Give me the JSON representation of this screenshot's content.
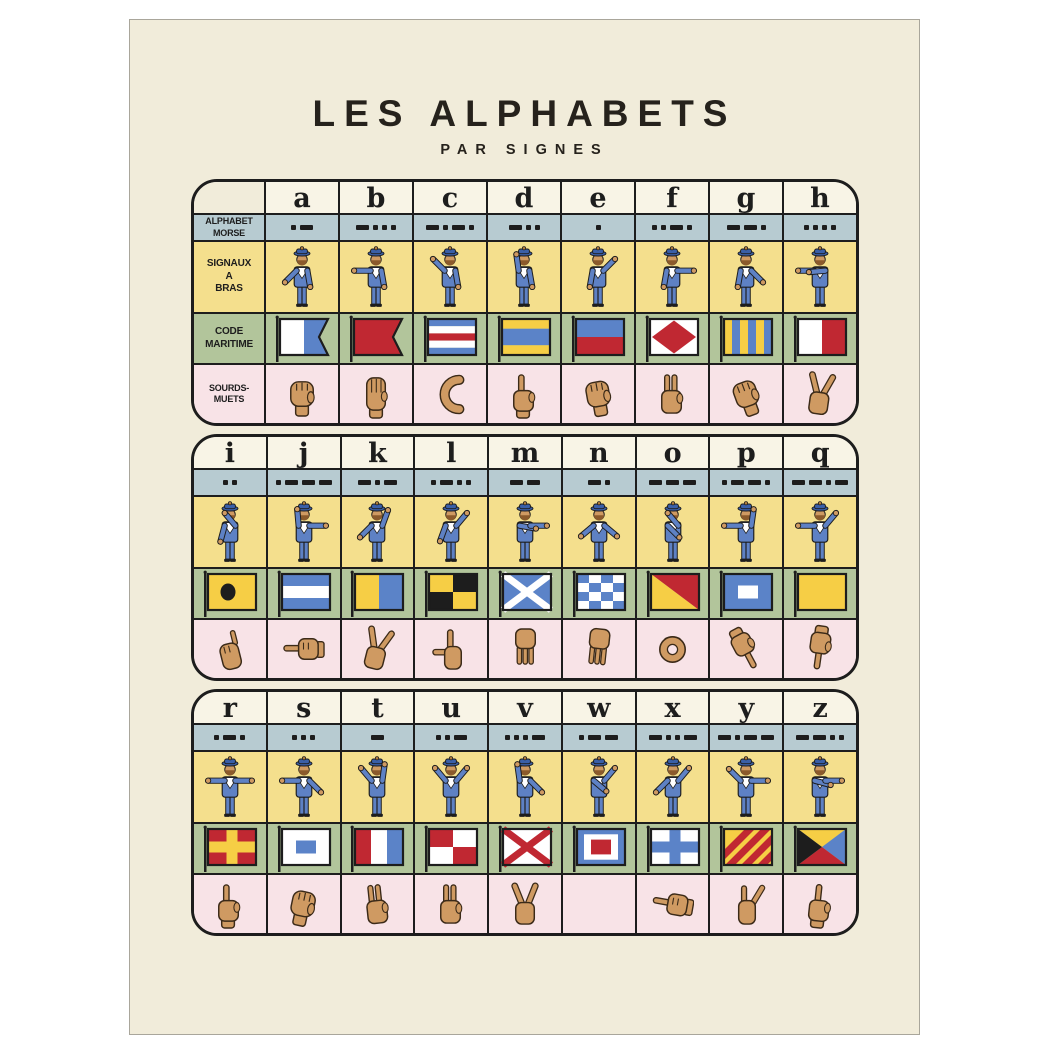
{
  "title": {
    "main": "LES ALPHABETS",
    "sub": "PAR SIGNES"
  },
  "row_labels": {
    "morse": "ALPHABET MORSE",
    "signaux_lines": [
      "SIGNAUX",
      "A",
      "BRAS"
    ],
    "maritime_lines": [
      "CODE",
      "MARITIME"
    ],
    "sourds": "SOURDS-MUETS"
  },
  "colors": {
    "poster_bg": "#f1ecda",
    "header_bg": "#f8f4e6",
    "morse_row": "#b7cbd1",
    "signaux_row": "#f4df8d",
    "maritime_row": "#b2c59b",
    "sourds_row": "#f8e3e7",
    "ink": "#1d1d1d",
    "flag_red": "#c02832",
    "flag_blue": "#5b83c8",
    "flag_yellow": "#f6ce45",
    "flag_white": "#ffffff",
    "flag_black": "#1d1d1d",
    "sailor_blue": "#5e81c4",
    "sailor_hat": "#3a5fa8",
    "skin": "#cf9a62"
  },
  "blocks": [
    {
      "letters": [
        "a",
        "b",
        "c",
        "d",
        "e",
        "f",
        "g",
        "h"
      ],
      "has_label_column": true
    },
    {
      "letters": [
        "i",
        "j",
        "k",
        "l",
        "m",
        "n",
        "o",
        "p",
        "q"
      ],
      "has_label_column": false
    },
    {
      "letters": [
        "r",
        "s",
        "t",
        "u",
        "v",
        "w",
        "x",
        "y",
        "z"
      ],
      "has_label_column": false
    }
  ],
  "alphabet": {
    "a": {
      "morse": ".-",
      "semaphore": {
        "la": 45,
        "ra": 10
      },
      "flag": {
        "kind": "swallowtail_vsplit",
        "colors": [
          "flag_white",
          "flag_blue"
        ]
      },
      "hand": "closed-fist",
      "hand_symbol": "hand-fist",
      "hand_rot": 0
    },
    "b": {
      "morse": "-...",
      "semaphore": {
        "la": 90,
        "ra": 10
      },
      "flag": {
        "kind": "swallowtail",
        "colors": [
          "flag_red"
        ]
      },
      "hand": "flat-hand-fingers-up",
      "hand_symbol": "hand-flat",
      "hand_rot": 0
    },
    "c": {
      "morse": "-.-.",
      "semaphore": {
        "la": 135,
        "ra": 10
      },
      "flag": {
        "kind": "hstripes",
        "colors": [
          "flag_blue",
          "flag_white",
          "flag_red",
          "flag_white",
          "flag_blue"
        ]
      },
      "hand": "c-shape",
      "hand_symbol": "hand-c",
      "hand_rot": 0
    },
    "d": {
      "morse": "-..",
      "semaphore": {
        "la": 172,
        "ra": 10
      },
      "flag": {
        "kind": "hstripes",
        "weights": [
          1,
          1.7,
          1
        ],
        "colors": [
          "flag_yellow",
          "flag_blue",
          "flag_yellow"
        ]
      },
      "hand": "index-up-curved",
      "hand_symbol": "hand-point-up",
      "hand_rot": 0
    },
    "e": {
      "morse": ".",
      "semaphore": {
        "la": 10,
        "ra": 135
      },
      "flag": {
        "kind": "hstripes",
        "colors": [
          "flag_blue",
          "flag_red"
        ]
      },
      "hand": "curled-fist",
      "hand_symbol": "hand-fist",
      "hand_rot": -10
    },
    "f": {
      "morse": "..-.",
      "semaphore": {
        "la": 10,
        "ra": 90
      },
      "flag": {
        "kind": "diamond",
        "colors": [
          "flag_white",
          "flag_red"
        ]
      },
      "hand": "two-fingers-thumb-circle",
      "hand_symbol": "hand-two-up",
      "hand_rot": 0
    },
    "g": {
      "morse": "--.",
      "semaphore": {
        "la": 10,
        "ra": 45
      },
      "flag": {
        "kind": "vstripes",
        "colors": [
          "flag_yellow",
          "flag_blue",
          "flag_yellow",
          "flag_blue",
          "flag_yellow",
          "flag_blue"
        ]
      },
      "hand": "bent-knuckles",
      "hand_symbol": "hand-fist",
      "hand_rot": -20
    },
    "h": {
      "morse": "....",
      "semaphore": {
        "la": 90,
        "ra": -85
      },
      "flag": {
        "kind": "vstripes",
        "colors": [
          "flag_white",
          "flag_red"
        ]
      },
      "hand": "two-fingers-spread",
      "hand_symbol": "hand-v",
      "hand_rot": 8
    },
    "i": {
      "morse": "..",
      "semaphore": {
        "la": 15,
        "ra": -140
      },
      "flag": {
        "kind": "circle",
        "colors": [
          "flag_yellow",
          "flag_black"
        ]
      },
      "hand": "pinky-raised",
      "hand_symbol": "hand-pinky",
      "hand_rot": -14
    },
    "j": {
      "morse": ".---",
      "semaphore": {
        "la": 175,
        "ra": 90
      },
      "flag": {
        "kind": "hstripes",
        "colors": [
          "flag_blue",
          "flag_white",
          "flag_blue"
        ]
      },
      "hand": "hand-pointing-left",
      "hand_symbol": "hand-point-left",
      "hand_rot": 0
    },
    "k": {
      "morse": "-.-",
      "semaphore": {
        "la": 45,
        "ra": 160
      },
      "flag": {
        "kind": "vstripes",
        "colors": [
          "flag_yellow",
          "flag_blue"
        ]
      },
      "hand": "index-middle-diagonal",
      "hand_symbol": "hand-v",
      "hand_rot": 14
    },
    "l": {
      "morse": ".-..",
      "semaphore": {
        "la": 20,
        "ra": 140
      },
      "flag": {
        "kind": "quarters",
        "colors": [
          "flag_yellow",
          "flag_black",
          "flag_black",
          "flag_yellow"
        ]
      },
      "hand": "l-shape-thumb-out",
      "hand_symbol": "hand-l",
      "hand_rot": 0
    },
    "m": {
      "morse": "--",
      "semaphore": {
        "la": -80,
        "ra": 90
      },
      "flag": {
        "kind": "saltire",
        "colors": [
          "flag_blue",
          "flag_white"
        ]
      },
      "hand": "three-fingers-down",
      "hand_symbol": "hand-fingers-down",
      "hand_rot": 0
    },
    "n": {
      "morse": "-.",
      "semaphore": {
        "la": 50,
        "ra": 50
      },
      "flag": {
        "kind": "checker",
        "colors": [
          "flag_blue",
          "flag_white"
        ]
      },
      "hand": "two-fingers-down",
      "hand_symbol": "hand-fingers-down",
      "hand_rot": 6
    },
    "o": {
      "morse": "---",
      "semaphore": {
        "la": -45,
        "ra": -140
      },
      "flag": {
        "kind": "diag",
        "colors": [
          "flag_red",
          "flag_yellow"
        ]
      },
      "hand": "o-shape",
      "hand_symbol": "hand-o",
      "hand_rot": 0
    },
    "p": {
      "morse": ".--.",
      "semaphore": {
        "la": 90,
        "ra": 172
      },
      "flag": {
        "kind": "center_rect",
        "colors": [
          "flag_blue",
          "flag_white"
        ]
      },
      "hand": "point-down-diagonal",
      "hand_symbol": "hand-point-down",
      "hand_rot": -28
    },
    "q": {
      "morse": "--.-",
      "semaphore": {
        "la": 90,
        "ra": 140
      },
      "flag": {
        "kind": "solid",
        "colors": [
          "flag_yellow"
        ]
      },
      "hand": "index-pointing-down",
      "hand_symbol": "hand-point-down",
      "hand_rot": 8
    },
    "r": {
      "morse": ".-.",
      "semaphore": {
        "la": 90,
        "ra": 90
      },
      "flag": {
        "kind": "cross",
        "colors": [
          "flag_red",
          "flag_yellow"
        ]
      },
      "hand": "index-up",
      "hand_symbol": "hand-point-up",
      "hand_rot": 0
    },
    "s": {
      "morse": "...",
      "semaphore": {
        "la": 90,
        "ra": 45
      },
      "flag": {
        "kind": "center_rect",
        "colors": [
          "flag_white",
          "flag_blue"
        ]
      },
      "hand": "pinched-fingers",
      "hand_symbol": "hand-fist",
      "hand_rot": 12
    },
    "t": {
      "morse": "-",
      "semaphore": {
        "la": 140,
        "ra": 172
      },
      "flag": {
        "kind": "vstripes",
        "colors": [
          "flag_red",
          "flag_white",
          "flag_blue"
        ]
      },
      "hand": "fingers-up-thumb-index-touch",
      "hand_symbol": "hand-two-up",
      "hand_rot": -6
    },
    "u": {
      "morse": "..-",
      "semaphore": {
        "la": 140,
        "ra": 140
      },
      "flag": {
        "kind": "quarters",
        "colors": [
          "flag_red",
          "flag_white",
          "flag_white",
          "flag_red"
        ]
      },
      "hand": "two-fingers-together-up",
      "hand_symbol": "hand-two-up",
      "hand_rot": 0
    },
    "v": {
      "morse": "...-",
      "semaphore": {
        "la": 172,
        "ra": 45
      },
      "flag": {
        "kind": "saltire",
        "colors": [
          "flag_white",
          "flag_red"
        ]
      },
      "hand": "v-sign",
      "hand_symbol": "hand-v",
      "hand_rot": 0
    },
    "w": {
      "morse": ".--",
      "semaphore": {
        "la": -50,
        "ra": 140
      },
      "flag": {
        "kind": "concentric",
        "colors": [
          "flag_blue",
          "flag_white",
          "flag_red"
        ]
      },
      "hand": "",
      "hand_symbol": "hand-none",
      "hand_rot": 0
    },
    "x": {
      "morse": "-..-",
      "semaphore": {
        "la": 45,
        "ra": 140
      },
      "flag": {
        "kind": "cross",
        "colors": [
          "flag_white",
          "flag_blue"
        ]
      },
      "hand": "bent-fist-sideways",
      "hand_symbol": "hand-point-left",
      "hand_rot": 10
    },
    "y": {
      "morse": "-.--",
      "semaphore": {
        "la": 135,
        "ra": 90
      },
      "flag": {
        "kind": "diag_stripes",
        "colors": [
          "flag_yellow",
          "flag_red"
        ]
      },
      "hand": "fingers-up-pinky-diagonal",
      "hand_symbol": "hand-y",
      "hand_rot": 0
    },
    "z": {
      "morse": "--..",
      "semaphore": {
        "la": -75,
        "ra": 90
      },
      "flag": {
        "kind": "triangles",
        "colors": [
          "flag_yellow",
          "flag_blue",
          "flag_red",
          "flag_black"
        ]
      },
      "hand": "index-up-from-fist",
      "hand_symbol": "hand-point-up",
      "hand_rot": 6
    }
  }
}
